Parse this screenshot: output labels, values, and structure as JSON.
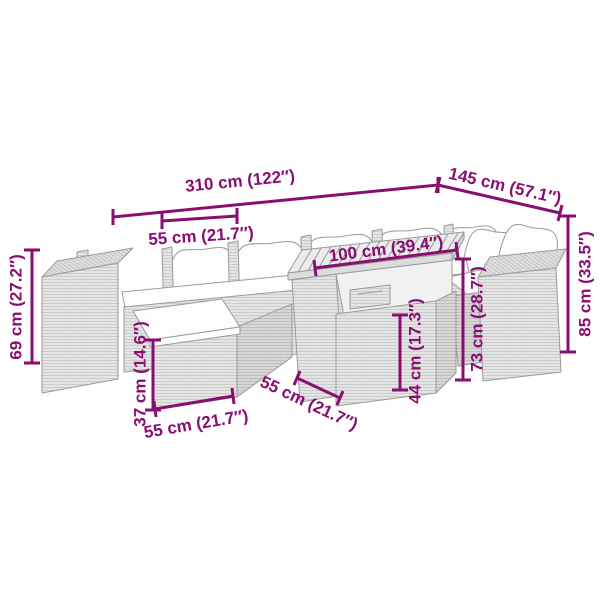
{
  "colors": {
    "dimension_accent": "#8A0E70",
    "furniture_outline": "#9A9A9A",
    "furniture_fill": "#E4E4E4",
    "cushion_fill": "#FDFDFD",
    "background": "#FFFFFF"
  },
  "dimensions": {
    "total_width": {
      "label": "310 cm (122″)"
    },
    "total_depth": {
      "label": "145 cm (57.1″)"
    },
    "back_height": {
      "label": "85 cm (33.5″)"
    },
    "left_height": {
      "label": "69 cm (27.2″)"
    },
    "seat_width": {
      "label": "55 cm (21.7″)"
    },
    "table_length": {
      "label": "100 cm (39.4″)"
    },
    "table_height": {
      "label": "73 cm (28.7″)"
    },
    "table_clearance": {
      "label": "44 cm (17.3″)"
    },
    "stool_height": {
      "label": "37 cm (14.6″)"
    },
    "stool_width": {
      "label": "55 cm (21.7″)"
    },
    "table_depth": {
      "label": "55 cm (21.7″)"
    }
  }
}
